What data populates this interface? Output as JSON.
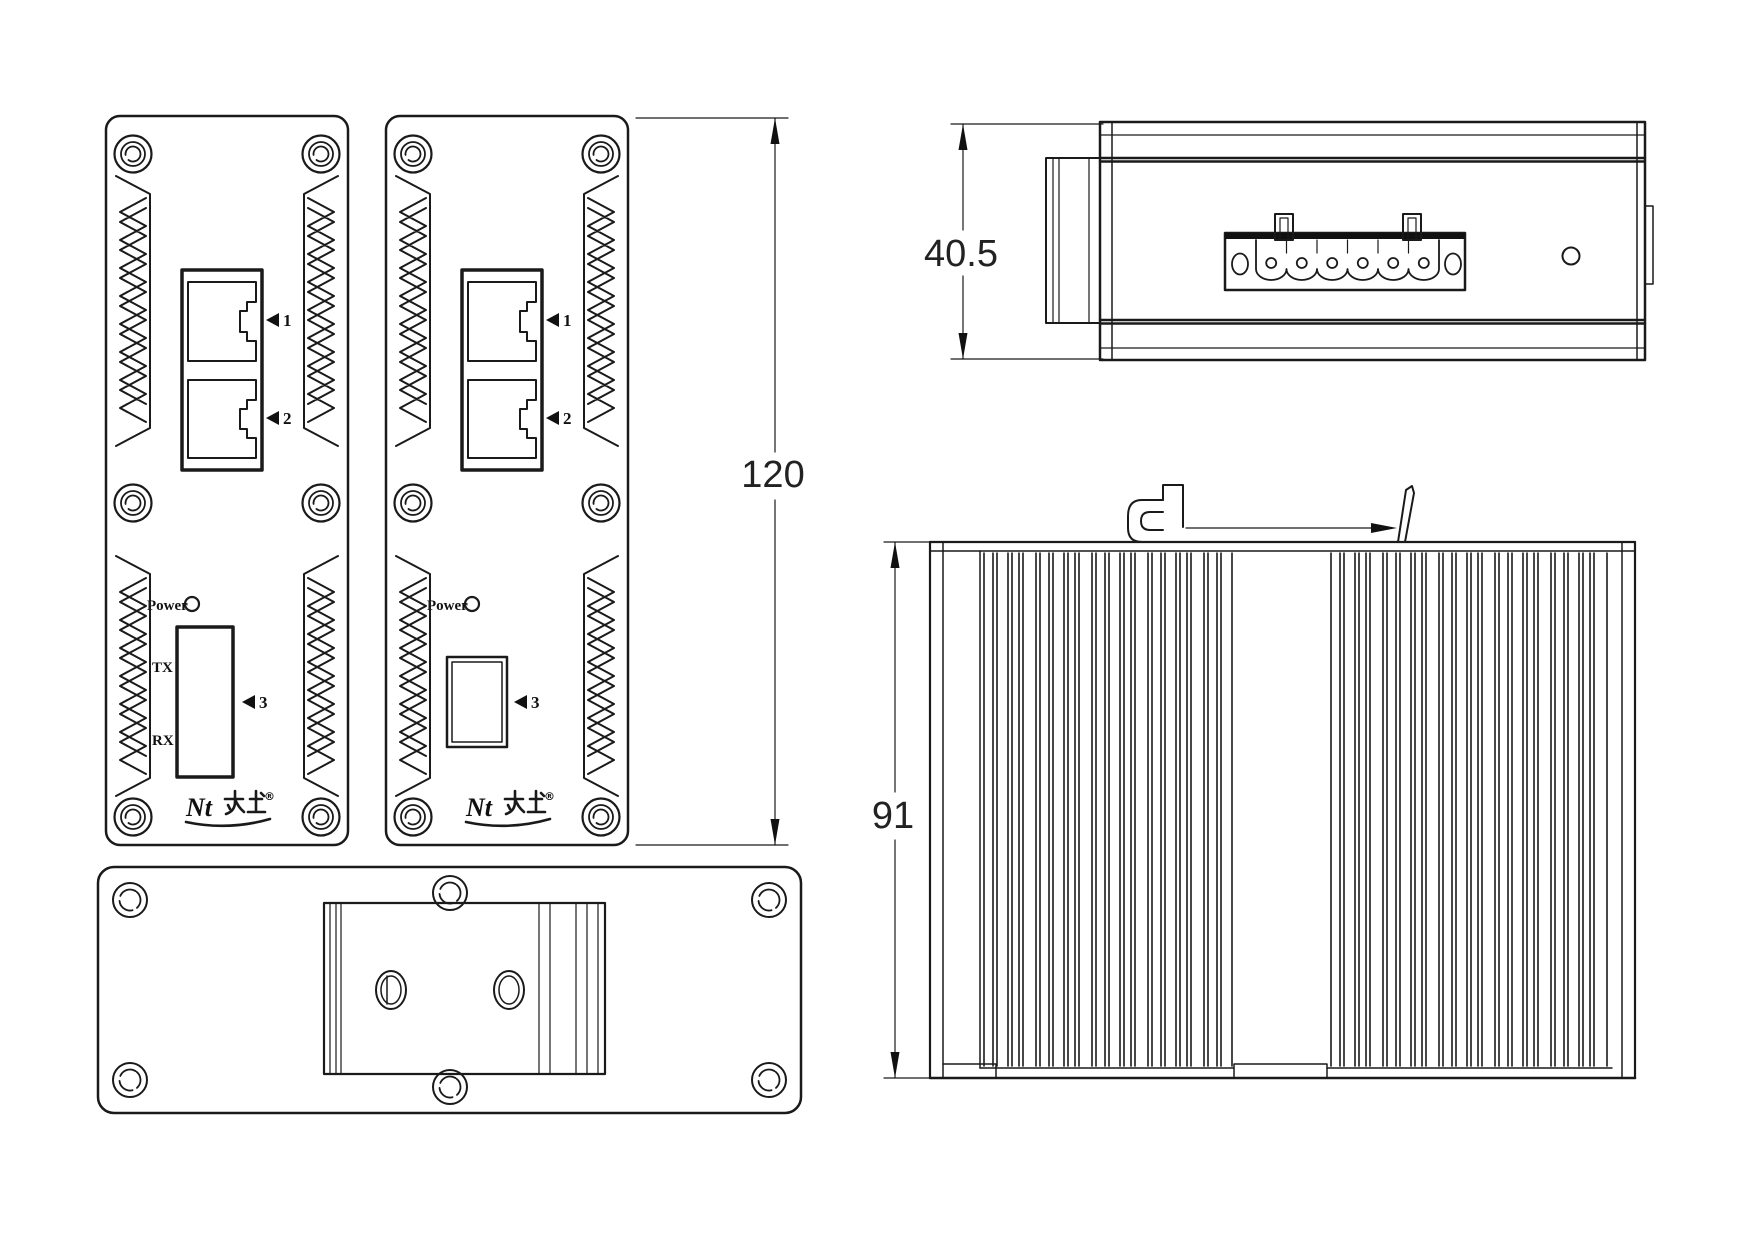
{
  "colors": {
    "line": "#1a1a1a",
    "background": "#ffffff"
  },
  "dimensions": {
    "front_height_mm": "120",
    "top_depth_mm": "40.5",
    "side_height_mm": "91"
  },
  "front_panels": {
    "power_label": "Power",
    "tx_label": "TX",
    "rx_label": "RX",
    "port1_label": "1",
    "port2_label": "2",
    "port3_label": "3",
    "brand_logo": {
      "latin": "Nt",
      "cjk": "办土",
      "registered_mark": "®"
    }
  }
}
